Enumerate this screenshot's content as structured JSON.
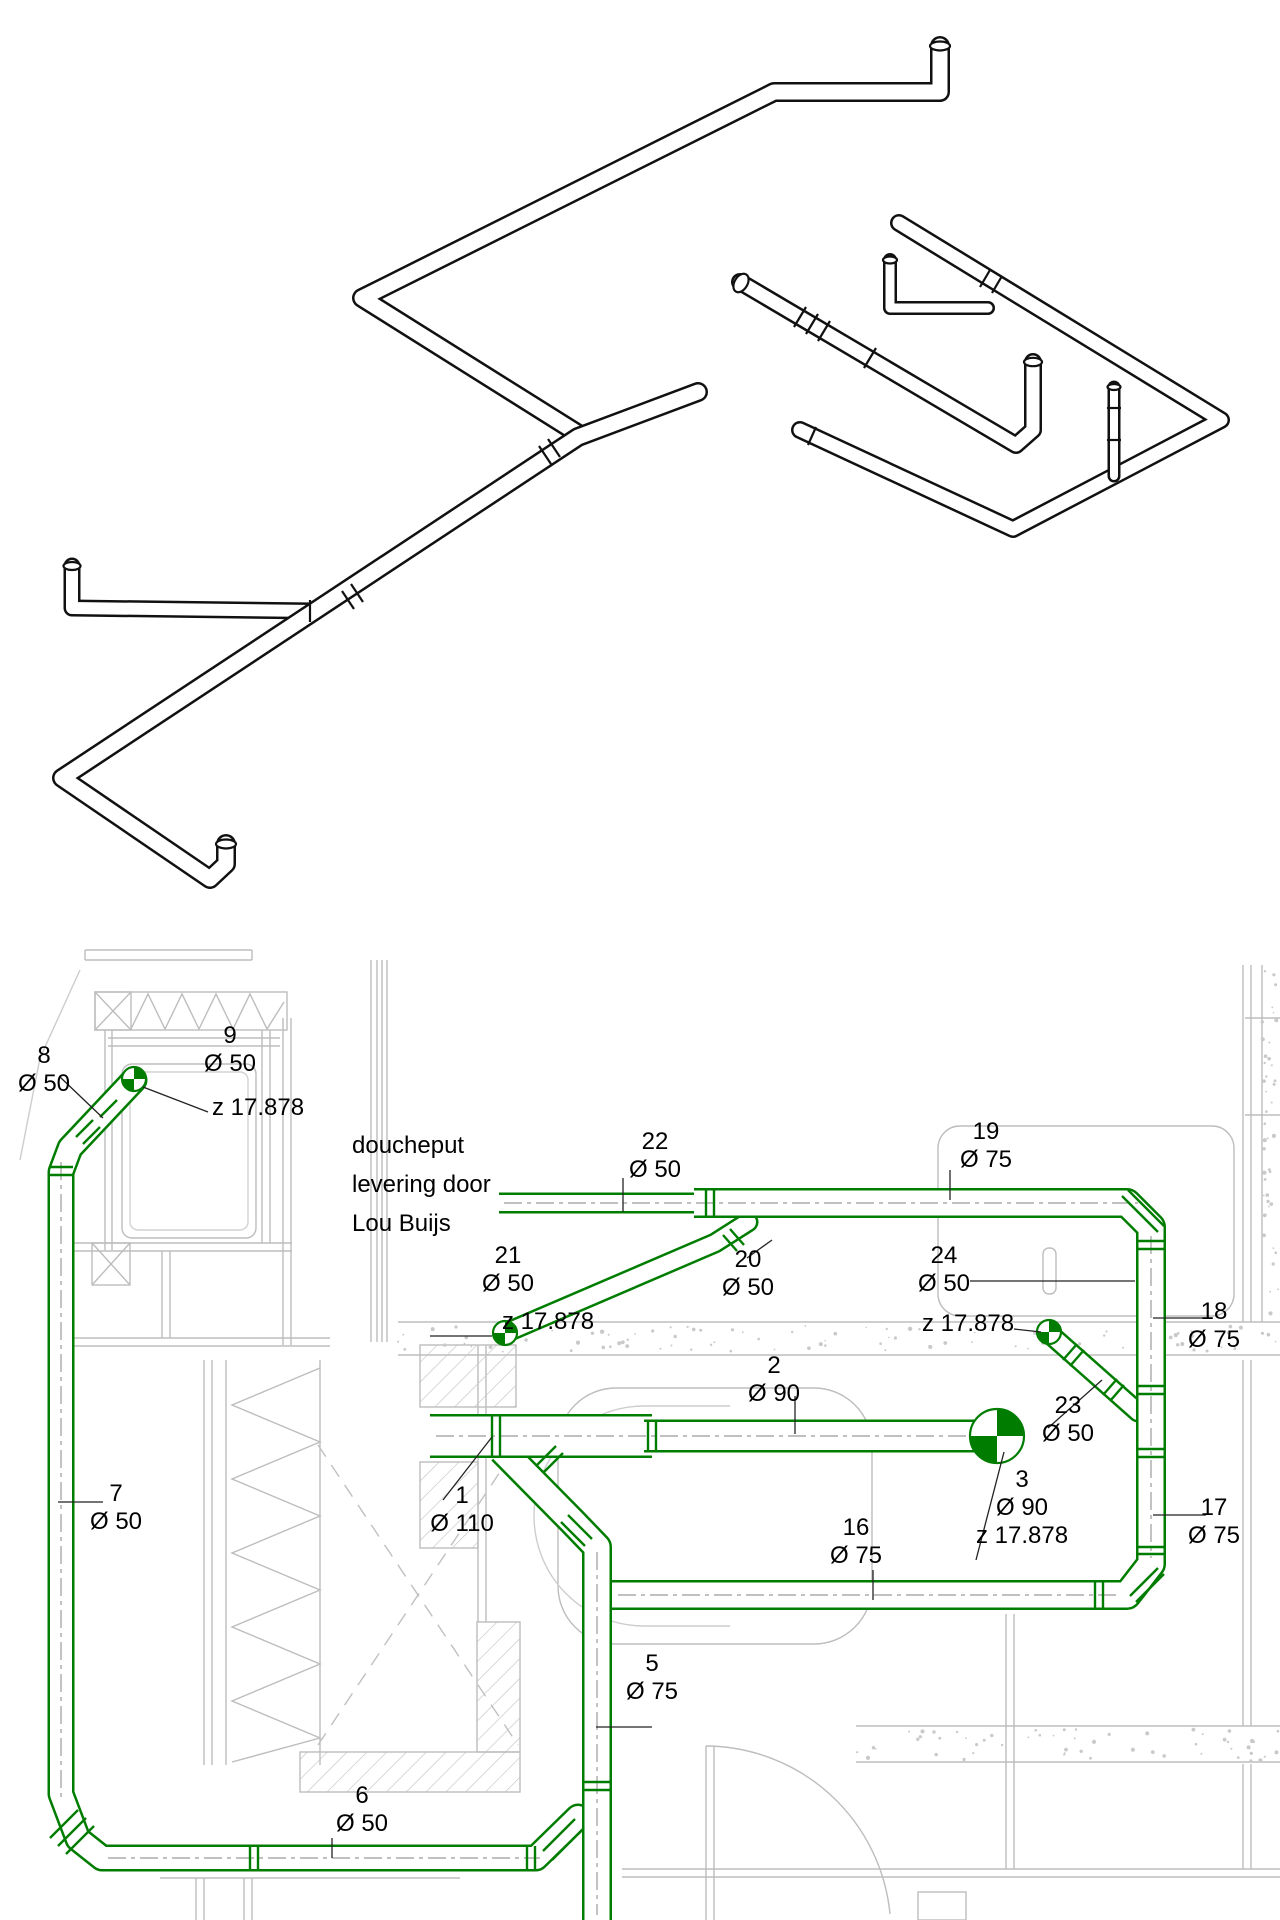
{
  "drawing": {
    "kind": "sanitary piping drawing",
    "views": [
      "isometric pipe run",
      "floor plan with piping"
    ]
  },
  "colors": {
    "pipe_green": "#007d00",
    "iso_black": "#111111",
    "bg_gray": "#bdbdbd",
    "dash_gray": "#9b9b9b",
    "leader_black": "#222222",
    "white": "#ffffff"
  },
  "note_block": {
    "x": 352,
    "y": 1126,
    "lines": [
      "doucheput",
      "levering door",
      "Lou Buijs"
    ]
  },
  "plan": {
    "labels": [
      {
        "name": "label-8",
        "cx": 44,
        "y": 1042,
        "lines": [
          "8",
          "Ø 50"
        ]
      },
      {
        "name": "label-9",
        "cx": 230,
        "y": 1022,
        "lines": [
          "9",
          "Ø 50"
        ]
      },
      {
        "name": "label-z-9",
        "cx": 258,
        "y": 1094,
        "lines": [
          "z 17.878"
        ]
      },
      {
        "name": "label-22",
        "cx": 655,
        "y": 1128,
        "lines": [
          "22",
          "Ø 50"
        ]
      },
      {
        "name": "label-19",
        "cx": 986,
        "y": 1118,
        "lines": [
          "19",
          "Ø 75"
        ]
      },
      {
        "name": "label-21",
        "cx": 508,
        "y": 1242,
        "lines": [
          "21",
          "Ø 50"
        ]
      },
      {
        "name": "label-20",
        "cx": 748,
        "y": 1246,
        "lines": [
          "20",
          "Ø 50"
        ]
      },
      {
        "name": "label-24",
        "cx": 944,
        "y": 1242,
        "lines": [
          "24",
          "Ø 50"
        ]
      },
      {
        "name": "label-z-20",
        "cx": 548,
        "y": 1308,
        "lines": [
          "z 17.878"
        ]
      },
      {
        "name": "label-z-23",
        "cx": 968,
        "y": 1310,
        "lines": [
          "z 17.878"
        ]
      },
      {
        "name": "label-18",
        "cx": 1214,
        "y": 1298,
        "lines": [
          "18",
          "Ø 75"
        ]
      },
      {
        "name": "label-2",
        "cx": 774,
        "y": 1352,
        "lines": [
          "2",
          "Ø 90"
        ]
      },
      {
        "name": "label-23",
        "cx": 1068,
        "y": 1392,
        "lines": [
          "23",
          "Ø 50"
        ]
      },
      {
        "name": "label-7",
        "cx": 116,
        "y": 1480,
        "lines": [
          "7",
          "Ø 50"
        ]
      },
      {
        "name": "label-1",
        "cx": 462,
        "y": 1482,
        "lines": [
          "1",
          "Ø 110"
        ]
      },
      {
        "name": "label-3",
        "cx": 1022,
        "y": 1466,
        "lines": [
          "3",
          "Ø 90",
          "z 17.878"
        ]
      },
      {
        "name": "label-16",
        "cx": 856,
        "y": 1514,
        "lines": [
          "16",
          "Ø 75"
        ]
      },
      {
        "name": "label-17",
        "cx": 1214,
        "y": 1494,
        "lines": [
          "17",
          "Ø 75"
        ]
      },
      {
        "name": "label-5",
        "cx": 652,
        "y": 1650,
        "lines": [
          "5",
          "Ø 75"
        ]
      },
      {
        "name": "label-6",
        "cx": 362,
        "y": 1782,
        "lines": [
          "6",
          "Ø 50"
        ]
      }
    ],
    "pipes": [
      {
        "name": "pipe-20",
        "pts": [
          [
            748,
            1222
          ],
          [
            715,
            1243
          ],
          [
            510,
            1331
          ]
        ],
        "w": 21,
        "cap": "round"
      },
      {
        "name": "pipe-23",
        "pts": [
          [
            1051,
            1335
          ],
          [
            1138,
            1412
          ]
        ],
        "w": 21,
        "cap": "round"
      },
      {
        "name": "pipe-8-7-6",
        "pts": [
          [
            134,
            1080
          ],
          [
            70,
            1148
          ],
          [
            61,
            1172
          ],
          [
            61,
            1794
          ],
          [
            78,
            1839
          ],
          [
            102,
            1858
          ],
          [
            536,
            1858
          ],
          [
            578,
            1817
          ]
        ],
        "w": 27,
        "cap": "round"
      },
      {
        "name": "pipe-22",
        "pts": [
          [
            499,
            1203
          ],
          [
            702,
            1203
          ]
        ],
        "w": 21,
        "cap": "butt"
      },
      {
        "name": "pipe-19-18-17-16",
        "pts": [
          [
            694,
            1203
          ],
          [
            1127,
            1203
          ],
          [
            1151,
            1227
          ],
          [
            1151,
            1564
          ],
          [
            1127,
            1595
          ],
          [
            612,
            1595
          ]
        ],
        "w": 30,
        "cap": "butt"
      },
      {
        "name": "pipe-branch-5",
        "pts": [
          [
            502,
            1450
          ],
          [
            572,
            1521
          ],
          [
            597,
            1547
          ],
          [
            597,
            1925
          ]
        ],
        "w": 30,
        "cap": "butt"
      },
      {
        "name": "pipe-1",
        "pts": [
          [
            430,
            1436
          ],
          [
            652,
            1436
          ]
        ],
        "w": 44,
        "cap": "butt"
      },
      {
        "name": "pipe-2",
        "pts": [
          [
            644,
            1436
          ],
          [
            983,
            1436
          ]
        ],
        "w": 33,
        "cap": "butt"
      }
    ],
    "dashes": [
      {
        "pts": [
          [
            61,
            1162
          ],
          [
            61,
            1798
          ]
        ]
      },
      {
        "pts": [
          [
            108,
            1858
          ],
          [
            540,
            1858
          ]
        ]
      },
      {
        "pts": [
          [
            436,
            1436
          ],
          [
            978,
            1436
          ]
        ]
      },
      {
        "pts": [
          [
            504,
            1203
          ],
          [
            1138,
            1203
          ]
        ]
      },
      {
        "pts": [
          [
            1151,
            1236
          ],
          [
            1151,
            1558
          ]
        ]
      },
      {
        "pts": [
          [
            618,
            1595
          ],
          [
            1120,
            1595
          ]
        ]
      },
      {
        "pts": [
          [
            597,
            1552
          ],
          [
            597,
            1915
          ]
        ]
      }
    ],
    "rings": [
      [
        49,
        1167,
        73,
        1167
      ],
      [
        49,
        1175,
        73,
        1175
      ],
      [
        76,
        1137,
        93,
        1120
      ],
      [
        83,
        1144,
        100,
        1127
      ],
      [
        100,
        1117,
        117,
        1100
      ],
      [
        250,
        1846,
        250,
        1870
      ],
      [
        258,
        1846,
        258,
        1870
      ],
      [
        527,
        1846,
        527,
        1870
      ],
      [
        535,
        1846,
        535,
        1870
      ],
      [
        492,
        1414,
        492,
        1458
      ],
      [
        500,
        1414,
        500,
        1458
      ],
      [
        648,
        1420,
        648,
        1452
      ],
      [
        656,
        1420,
        656,
        1452
      ],
      [
        706,
        1188,
        706,
        1218
      ],
      [
        714,
        1188,
        714,
        1218
      ],
      [
        1137,
        1241,
        1165,
        1241
      ],
      [
        1137,
        1249,
        1165,
        1249
      ],
      [
        1137,
        1386,
        1165,
        1386
      ],
      [
        1137,
        1394,
        1165,
        1394
      ],
      [
        1137,
        1449,
        1165,
        1449
      ],
      [
        1137,
        1457,
        1165,
        1457
      ],
      [
        1137,
        1547,
        1165,
        1547
      ],
      [
        1137,
        1554,
        1165,
        1554
      ],
      [
        1095,
        1581,
        1095,
        1609
      ],
      [
        1103,
        1581,
        1103,
        1609
      ],
      [
        583,
        1782,
        611,
        1782
      ],
      [
        583,
        1790,
        611,
        1790
      ],
      [
        536,
        1466,
        556,
        1446
      ],
      [
        543,
        1473,
        563,
        1453
      ],
      [
        730,
        1229,
        744,
        1245
      ],
      [
        723,
        1235,
        737,
        1251
      ],
      [
        1077,
        1344,
        1063,
        1360
      ],
      [
        1084,
        1350,
        1070,
        1366
      ],
      [
        1117,
        1379,
        1103,
        1395
      ],
      [
        1124,
        1385,
        1110,
        1401
      ],
      [
        50,
        1838,
        78,
        1810
      ],
      [
        58,
        1846,
        86,
        1818
      ],
      [
        66,
        1854,
        94,
        1826
      ],
      [
        1128,
        1190,
        1164,
        1226
      ],
      [
        1122,
        1196,
        1158,
        1232
      ],
      [
        1130,
        1596,
        1158,
        1568
      ],
      [
        1136,
        1602,
        1164,
        1574
      ],
      [
        568,
        1515,
        592,
        1539
      ],
      [
        561,
        1522,
        585,
        1546
      ],
      [
        543,
        1851,
        575,
        1819
      ],
      [
        552,
        1860,
        584,
        1828
      ]
    ],
    "ellipses": [
      {
        "x": 981,
        "y": 1436,
        "rx": 8,
        "ry": 16.5,
        "rot": 0
      }
    ],
    "markers": [
      {
        "name": "survey-point-9",
        "x": 134,
        "y": 1079,
        "r": 12
      },
      {
        "name": "survey-point-20",
        "x": 505,
        "y": 1333,
        "r": 12
      },
      {
        "name": "survey-point-23",
        "x": 1049,
        "y": 1332,
        "r": 12
      },
      {
        "name": "survey-point-3",
        "x": 997,
        "y": 1436,
        "r": 27
      }
    ],
    "leaders": [
      [
        60,
        1077,
        103,
        1118
      ],
      [
        143,
        1087,
        208,
        1112
      ],
      [
        623,
        1178,
        623,
        1212
      ],
      [
        950,
        1170,
        950,
        1200
      ],
      [
        772,
        1240,
        747,
        1258
      ],
      [
        970,
        1281,
        1135,
        1281
      ],
      [
        430,
        1336,
        492,
        1336
      ],
      [
        1014,
        1329,
        1041,
        1332
      ],
      [
        1153,
        1318,
        1206,
        1318
      ],
      [
        1048,
        1428,
        1102,
        1380
      ],
      [
        795,
        1396,
        795,
        1434
      ],
      [
        443,
        1500,
        492,
        1437
      ],
      [
        1004,
        1452,
        976,
        1560
      ],
      [
        873,
        1570,
        873,
        1600
      ],
      [
        1153,
        1515,
        1206,
        1515
      ],
      [
        596,
        1727,
        652,
        1727
      ],
      [
        332,
        1838,
        332,
        1858
      ],
      [
        58,
        1502,
        103,
        1502
      ]
    ],
    "speckle_bands": [
      {
        "x": 398,
        "y": 1325,
        "w": 880,
        "h": 28,
        "n": 95
      },
      {
        "x": 1262,
        "y": 968,
        "w": 16,
        "h": 352,
        "n": 42
      },
      {
        "x": 856,
        "y": 1729,
        "w": 422,
        "h": 32,
        "n": 55
      }
    ]
  },
  "iso": {
    "runs": [
      {
        "name": "iso-left-branch",
        "pts": [
          [
            72,
            566
          ],
          [
            72,
            608
          ],
          [
            314,
            611
          ]
        ],
        "w": 17
      },
      {
        "name": "iso-main-top-run",
        "pts": [
          [
            940,
            46
          ],
          [
            940,
            92
          ],
          [
            774,
            92
          ],
          [
            362,
            298
          ],
          [
            577,
            433
          ]
        ],
        "w": 20
      },
      {
        "name": "iso-right-small-l",
        "pts": [
          [
            890,
            260
          ],
          [
            890,
            308
          ],
          [
            988,
            308
          ]
        ],
        "w": 14
      },
      {
        "name": "iso-main-lower-run",
        "pts": [
          [
            698,
            392
          ],
          [
            578,
            437
          ],
          [
            62,
            778
          ],
          [
            210,
            879
          ],
          [
            226,
            864
          ],
          [
            226,
            844
          ]
        ],
        "w": 20
      },
      {
        "name": "iso-flex-branch",
        "pts": [
          [
            740,
            282
          ],
          [
            1016,
            445
          ],
          [
            1033,
            430
          ],
          [
            1033,
            362
          ]
        ],
        "w": 18
      },
      {
        "name": "iso-right-loop",
        "pts": [
          [
            899,
            223
          ],
          [
            1221,
            420
          ],
          [
            1013,
            529
          ],
          [
            800,
            430
          ]
        ],
        "w": 18
      },
      {
        "name": "iso-thin-riser",
        "pts": [
          [
            1114,
            476
          ],
          [
            1114,
            387
          ]
        ],
        "w": 13
      }
    ],
    "ellipses": [
      {
        "x": 940,
        "y": 46,
        "rx": 10,
        "ry": 4.5,
        "rot": 0
      },
      {
        "x": 226,
        "y": 844,
        "rx": 10,
        "ry": 4.5,
        "rot": 0
      },
      {
        "x": 72,
        "y": 566,
        "rx": 8.5,
        "ry": 4,
        "rot": 0
      },
      {
        "x": 741,
        "y": 283,
        "rx": 6.5,
        "ry": 10,
        "rot": 31
      },
      {
        "x": 1033,
        "y": 362,
        "rx": 9,
        "ry": 4.2,
        "rot": 0
      },
      {
        "x": 890,
        "y": 260,
        "rx": 7,
        "ry": 3.5,
        "rot": 0
      },
      {
        "x": 1114,
        "y": 387,
        "rx": 6.5,
        "ry": 3,
        "rot": 0
      }
    ],
    "rings": [
      [
        310,
        600,
        310,
        622
      ],
      [
        342,
        591,
        354,
        609
      ],
      [
        351,
        584,
        363,
        602
      ],
      [
        539,
        446,
        551,
        464
      ],
      [
        548,
        439,
        560,
        457
      ],
      [
        980,
        287,
        990,
        270
      ],
      [
        992,
        293,
        1002,
        276
      ],
      [
        794,
        327,
        806,
        307
      ],
      [
        806,
        334,
        818,
        314
      ],
      [
        818,
        341,
        830,
        321
      ],
      [
        864,
        368,
        876,
        348
      ],
      [
        1107,
        440,
        1121,
        440
      ],
      [
        1107,
        408,
        1121,
        408
      ],
      [
        808,
        445,
        816,
        427
      ]
    ]
  }
}
